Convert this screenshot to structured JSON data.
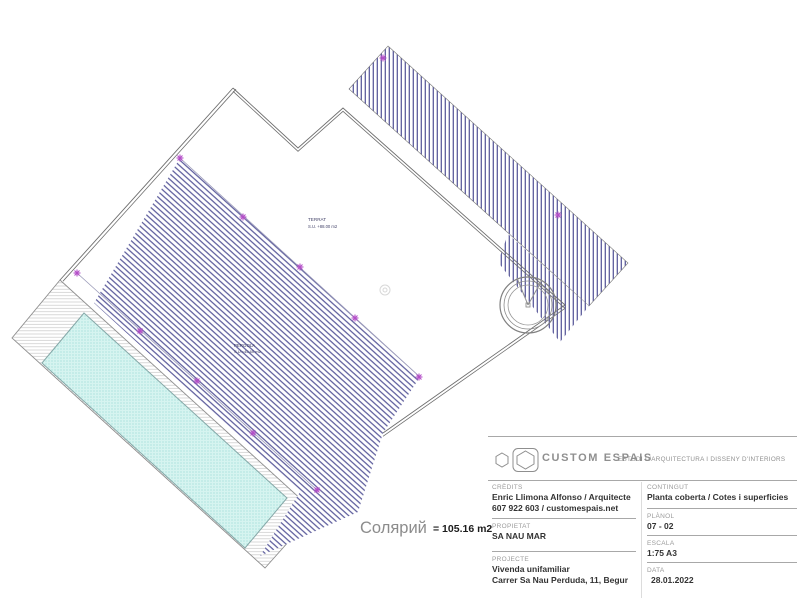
{
  "plan": {
    "terrat_label": "TERRAT",
    "terrat_area": "S.U. +88.00 m2",
    "pergola_label": "PERGOLA",
    "pergola_area": "S.U.=45.60 m2",
    "solarium_label": "Солярий",
    "solarium_value": "= 105.16 m2"
  },
  "title_block": {
    "brand": "CUSTOM ESPAIS",
    "brand_tagline": "ESTUDI D'ARQUITECTURA I DISSENY D'INTERIORS",
    "credits": {
      "label": "CRÈDITS",
      "line1": "Enric Llimona Alfonso / Arquitecte",
      "line2": "607 922 603 / customespais.net"
    },
    "propietat": {
      "label": "PROPIETAT",
      "value": "SA NAU MAR"
    },
    "projecte": {
      "label": "PROJECTE",
      "line1": "Vivenda unifamiliar",
      "line2": "Carrer Sa Nau Perduda, 11, Begur"
    },
    "contingut": {
      "label": "CONTINGUT",
      "value": "Planta coberta / Cotes i superficies"
    },
    "planol": {
      "label": "PLÀNOL",
      "value": "07 - 02"
    },
    "escala": {
      "label": "ESCALA",
      "value": "1:75  A3"
    },
    "data": {
      "label": "DATA",
      "value": "28.01.2022"
    }
  },
  "colors": {
    "hatch": "#5c5c9c",
    "outline": "#6e6e6e",
    "marker_accent": "#b44fc8",
    "pool_fill": "#d6f4f0",
    "pool_dot": "#7fd0ca",
    "title_line": "#a8a8a8",
    "title_label": "#9b9b9b",
    "title_value": "#333333",
    "brand_gray": "#8f8f8f"
  }
}
